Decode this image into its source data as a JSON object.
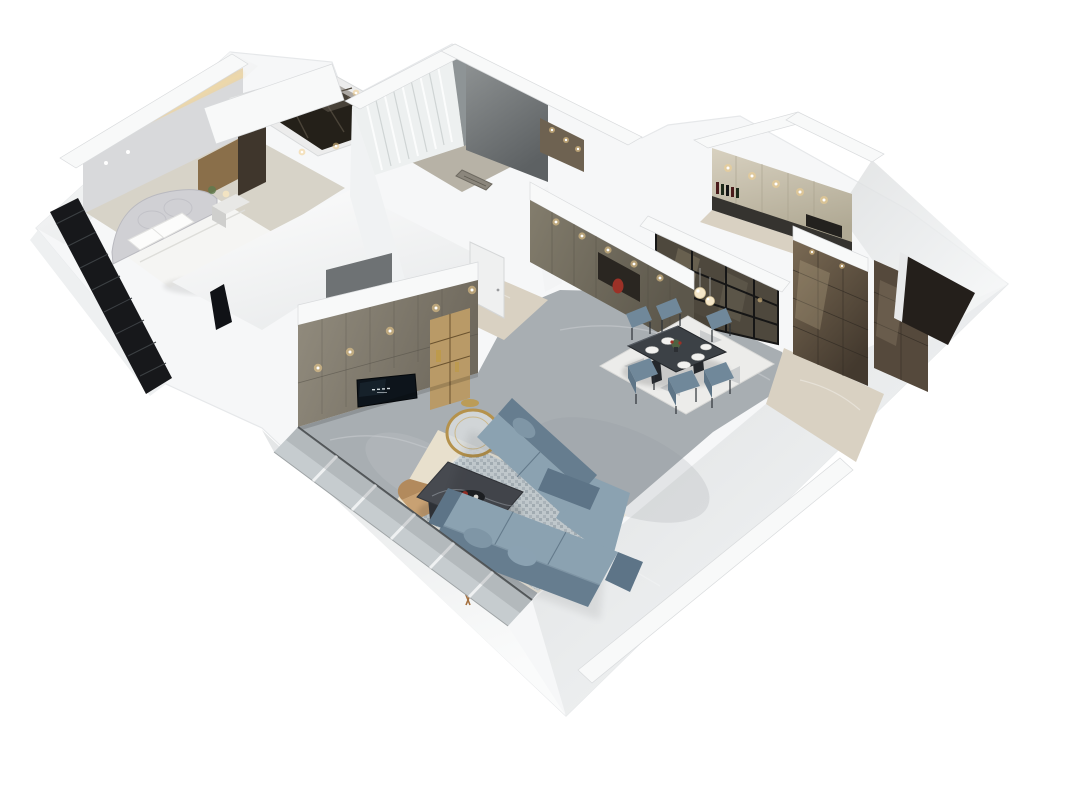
{
  "scene": {
    "description": "Isometric 3D cutaway dollhouse render of an apartment: master bedroom with upholstered bed, walk-in closet, bathroom with sheer curtains, hallway, kitchen with black-framed glass partition, dining room with six blue chairs, study with bronze glass cabinets, and a living room with blue L-shaped sectional sofa, marble coffee table, gold round mirror and TV media wall",
    "rooms": [
      {
        "id": "master-bedroom",
        "label": "Master bedroom"
      },
      {
        "id": "walk-in-closet",
        "label": "Walk-in closet"
      },
      {
        "id": "bathroom",
        "label": "Bathroom"
      },
      {
        "id": "hallway",
        "label": "Hallway"
      },
      {
        "id": "kitchen",
        "label": "Kitchen"
      },
      {
        "id": "dining-room",
        "label": "Dining room"
      },
      {
        "id": "study-bedroom",
        "label": "Study"
      },
      {
        "id": "living-room",
        "label": "Living room"
      }
    ]
  },
  "colors": {
    "bg": "#ffffff",
    "wall": "#f6f7f8",
    "wallShade": "#e9ebed",
    "band": "#f8f9f9",
    "edge": "#d9dbdd",
    "floorGray": "#a8aeb2",
    "floorBeige": "#d9d1c2",
    "floorIvory": "#d7d3c8",
    "floorBath": "#b7b2a6",
    "cabinetTaupe": "#8a8478",
    "cabinetOlive": "#7a7465",
    "bronze": "#6b5c49",
    "bronzeDark": "#55493c",
    "nicheDark": "#2a2621",
    "tvScreen": "#0d141b",
    "sofa": "#8ba2b1",
    "sofaDark": "#667d8f",
    "sofaArm": "#5d7487",
    "sofaSeam": "#5a7082",
    "chairBlue": "#70889a",
    "tableDark": "#3c4146",
    "rugLiving": "#ccd5da",
    "rugDining": "#ececea",
    "rugBeige": "#e8e0cd",
    "gold": "#bd9a4c",
    "warmLight": "#f3cf8e",
    "bedWhite": "#f5f5f3",
    "headboard": "#d0d0d4",
    "curtain": "#edf0f0",
    "glassPane": "#c6cccf",
    "frameBlack": "#161616",
    "wood": "#8a6f4a",
    "woodLight": "#b99a67",
    "accentRed": "#9c3127",
    "tanChair": "#c8a173",
    "louver": "#17181b"
  }
}
